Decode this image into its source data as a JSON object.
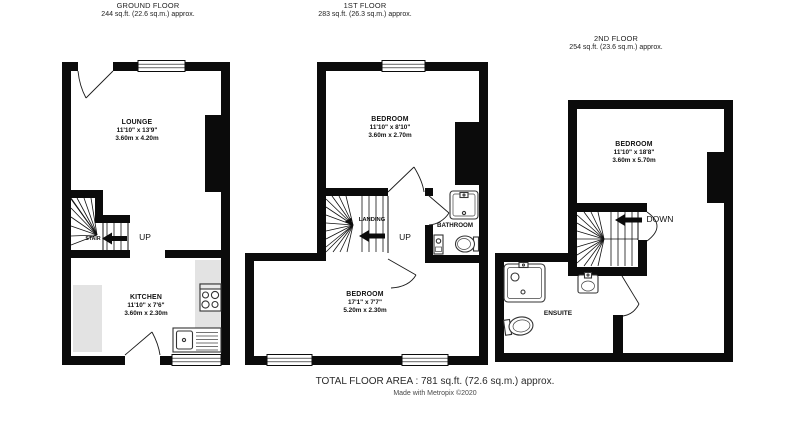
{
  "colors": {
    "wall": "#0b0b0b",
    "counter": "#e3e3e3",
    "fixture_outline": "#333333",
    "text": "#1a1a1a",
    "credit_text": "#4a4a4a"
  },
  "floors": [
    {
      "title": "GROUND FLOOR",
      "area": "244 sq.ft. (22.6 sq.m.) approx.",
      "rooms": [
        {
          "name": "LOUNGE",
          "dims_imperial": "11'10\" x 13'9\"",
          "dims_metric": "3.60m x 4.20m"
        },
        {
          "name": "KITCHEN",
          "dims_imperial": "11'10\" x 7'6\"",
          "dims_metric": "3.60m x 2.30m"
        }
      ],
      "stair_label": "STAIR",
      "direction_label": "UP"
    },
    {
      "title": "1ST FLOOR",
      "area": "283 sq.ft. (26.3 sq.m.) approx.",
      "rooms": [
        {
          "name": "BEDROOM",
          "dims_imperial": "11'10\" x 8'10\"",
          "dims_metric": "3.60m x 2.70m"
        },
        {
          "name": "BEDROOM",
          "dims_imperial": "17'1\" x 7'7\"",
          "dims_metric": "5.20m x 2.30m"
        },
        {
          "name": "BATHROOM"
        }
      ],
      "landing_label": "LANDING",
      "direction_label": "UP"
    },
    {
      "title": "2ND FLOOR",
      "area": "254 sq.ft. (23.6 sq.m.) approx.",
      "rooms": [
        {
          "name": "BEDROOM",
          "dims_imperial": "11'10\" x 18'8\"",
          "dims_metric": "3.60m x 5.70m"
        },
        {
          "name": "ENSUITE"
        }
      ],
      "direction_label": "DOWN"
    }
  ],
  "footer": {
    "total_area": "TOTAL FLOOR AREA : 781 sq.ft. (72.6 sq.m.) approx.",
    "credit": "Made with Metropix ©2020"
  }
}
